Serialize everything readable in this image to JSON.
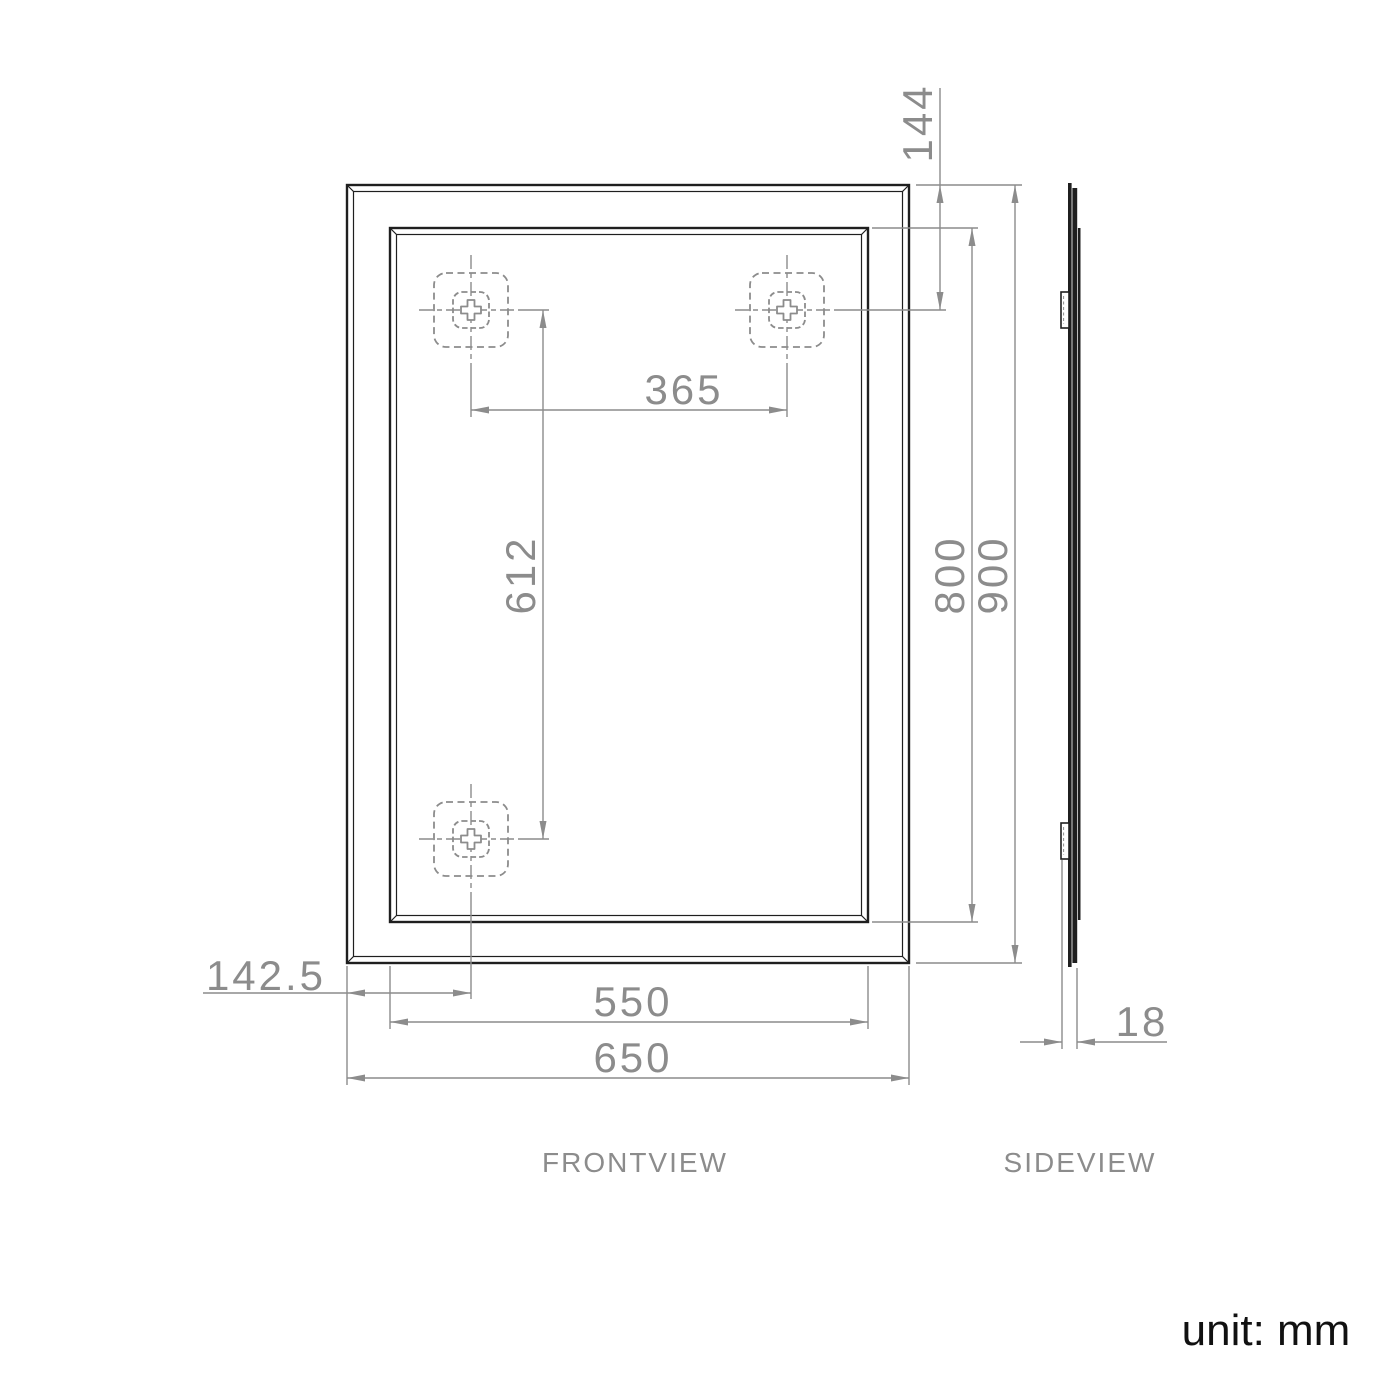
{
  "drawing": {
    "type": "technical-dimension-drawing",
    "subject": "framed rectangular mirror, front and side orthographic views",
    "unit_note": "unit: mm",
    "views": {
      "front_label": "FRONTVIEW",
      "side_label": "SIDEVIEW"
    },
    "dimensions": {
      "top_hole_offset": "144",
      "top_hole_spacing": "365",
      "vertical_hole_spacing": "612",
      "inner_height": "800",
      "overall_height": "900",
      "bottom_hole_left_offset": "142.5",
      "inner_width": "550",
      "overall_width": "650",
      "depth": "18"
    },
    "colors": {
      "outline_black": "#1f1f1f",
      "dimension_gray": "#8c8c8c",
      "note_black": "#111111",
      "background": "#ffffff"
    }
  }
}
